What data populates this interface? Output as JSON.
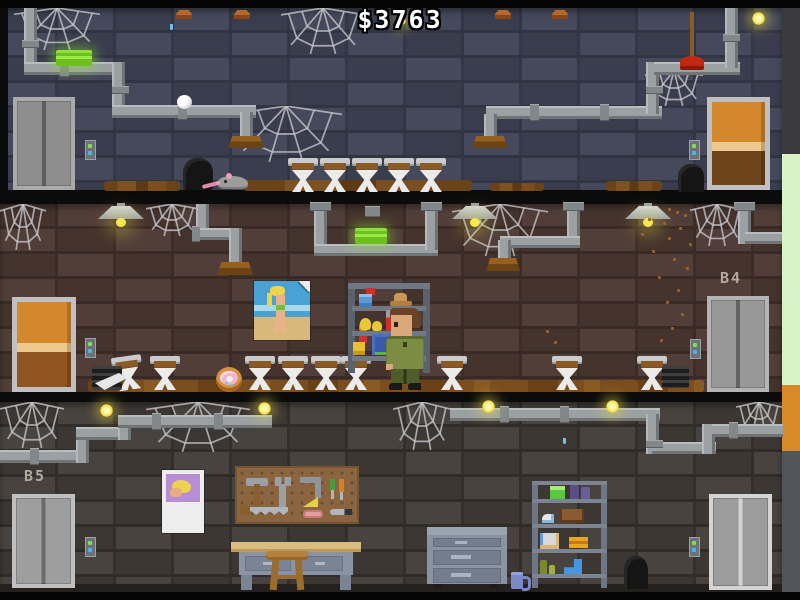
{
  "hud": {
    "money": "$3763"
  },
  "floors": [
    {
      "name": "top-basement",
      "label": "",
      "fixtures": [
        "elevator-door",
        "call-button",
        "wooden-door",
        "toilet",
        "rat",
        "trash-bag",
        "plunger",
        "soap-bar",
        "pipe",
        "cobweb",
        "ceiling-cap",
        "moth",
        "firefly"
      ],
      "toilet_count": 5
    },
    {
      "name": "basement-4",
      "label": "B4",
      "fixtures": [
        "wooden-door",
        "call-button",
        "elevator-door",
        "pinup-poster",
        "supply-shelf",
        "spray-bottle",
        "hat",
        "feather-duster",
        "soap-box",
        "bucket",
        "janitor",
        "toilet",
        "donut",
        "ceiling-lamp",
        "soap-bar",
        "pipe",
        "cobweb",
        "falling-dust",
        "floor-vent"
      ],
      "toilet_count": 9
    },
    {
      "name": "basement-5",
      "label": "B5",
      "fixtures": [
        "elevator-door",
        "call-button",
        "calendar",
        "pegboard",
        "hammer",
        "wrench",
        "saw",
        "screwdriver",
        "workbench",
        "stool",
        "file-cabinet",
        "mug",
        "storage-shelf",
        "boot",
        "trash-bag",
        "pipe",
        "cobweb",
        "firefly"
      ],
      "toilet_count": 0
    }
  ],
  "palette": {
    "money_text": "#ffffff",
    "wall_top": "#3f4255",
    "wall_mid": "#4b3731",
    "wall_bottom": "#413c37",
    "dirt": "#7a4e1e",
    "pipe": "#9ba1a3",
    "soap_green": "#7fd622",
    "door_orange": "#d4882e",
    "elevator_gray": "#b2b2b2",
    "lamp_yellow": "#f6e84e",
    "shaft_green": "#d9f2c6",
    "shaft_orange": "#d8892a",
    "call_button_green": "#7ae24a",
    "call_button_blue": "#4ab4f0"
  }
}
